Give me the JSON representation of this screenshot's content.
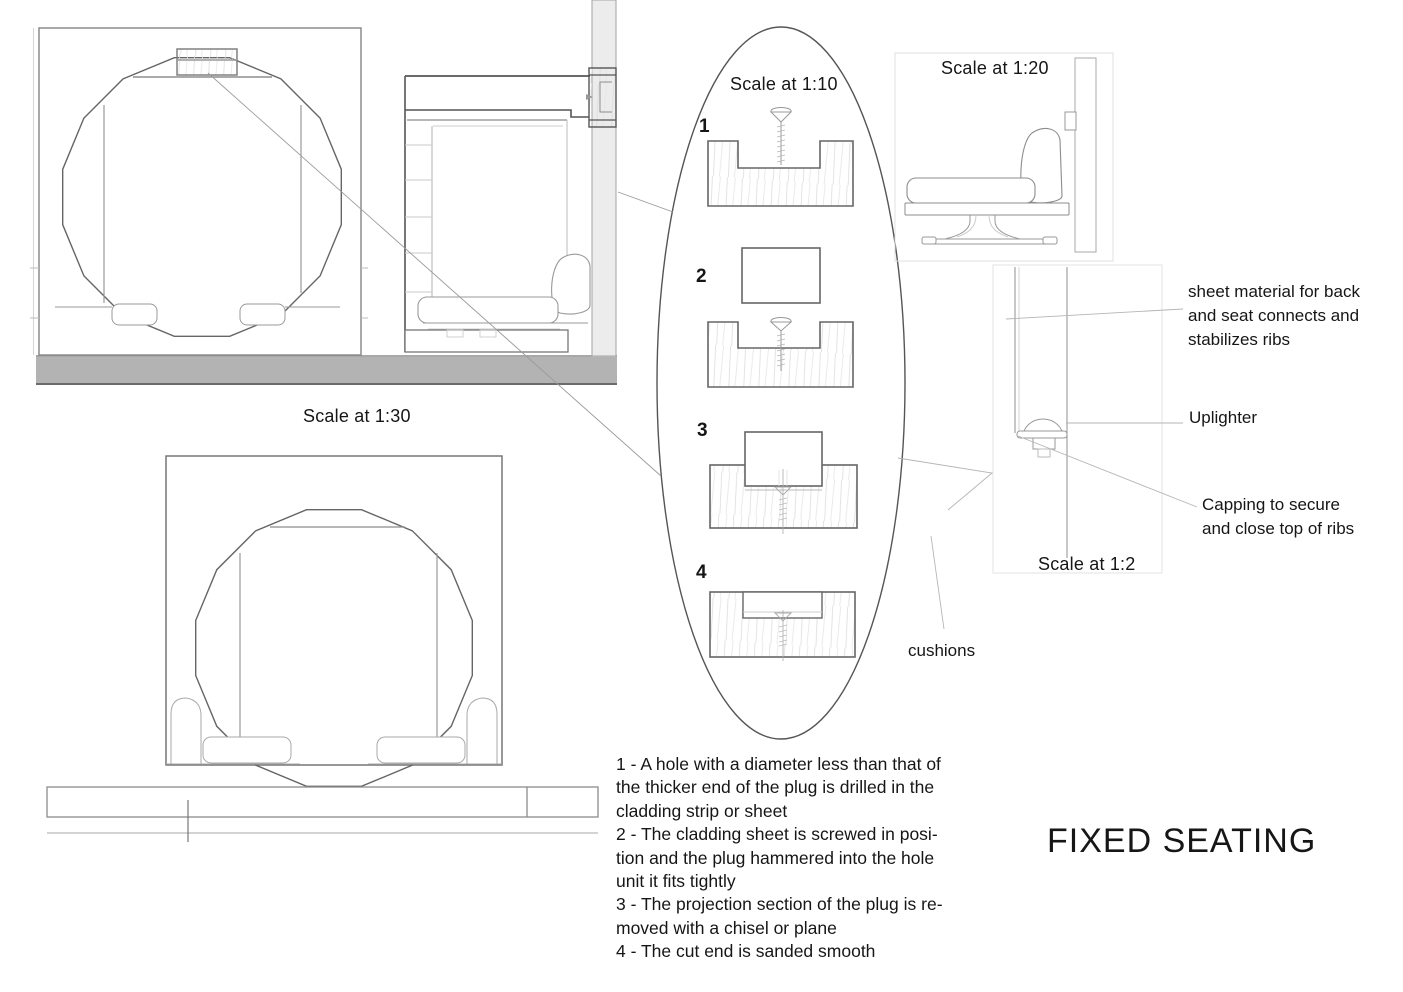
{
  "page_title": "FIXED SEATING",
  "scales": {
    "s30": "Scale at 1:30",
    "s10": "Scale at 1:10",
    "s20": "Scale at 1:20",
    "s2": "Scale at 1:2"
  },
  "steps": [
    "1",
    "2",
    "3",
    "4"
  ],
  "annotations": {
    "sheet_material": "sheet material for back\nand seat connects and\nstabilizes ribs",
    "uplighter": "Uplighter",
    "capping": "Capping to secure\nand close top of ribs",
    "cushions": "cushions"
  },
  "notes": "1 - A hole with a diameter less than that of\nthe thicker end of the plug is drilled in the\ncladding strip or sheet\n2 - The cladding sheet is screwed in posi-\ntion and the plug hammered into the hole\nunit it fits tightly\n3 - The projection section of the plug is re-\nmoved with a chisel or plane\n4 - The cut end is sanded smooth",
  "colors": {
    "line_dark": "#4d4d4d",
    "line_mid": "#8c8c8c",
    "line_light": "#cccccc",
    "wall_fill": "#ececec",
    "floor_fill": "#b3b3b3",
    "text": "#111111"
  }
}
